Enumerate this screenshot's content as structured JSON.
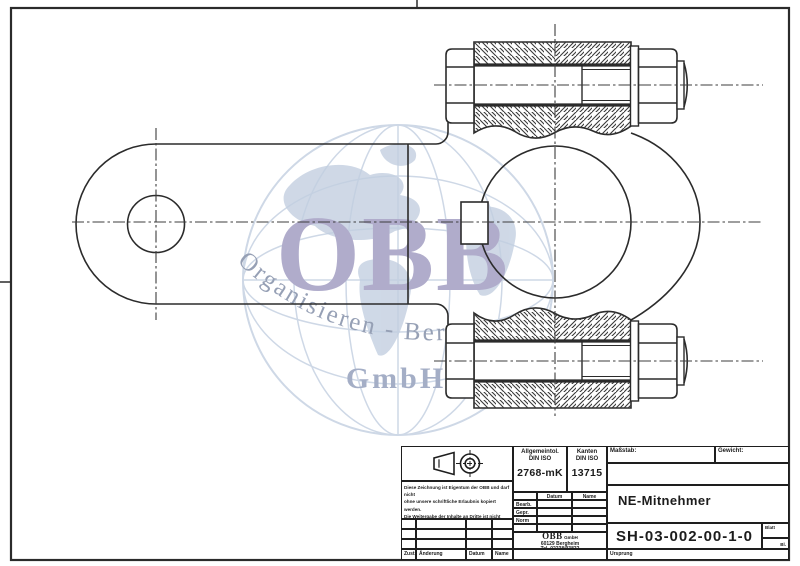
{
  "colors": {
    "line": "#2b2b2b",
    "centerline": "#3d3d3d",
    "watermark_globe": "#c9d4e4",
    "watermark_land": "#bccadd",
    "watermark_obb": "#a8a4c6",
    "watermark_arc_text": "#8b96ae",
    "watermark_gmbh": "#9ba6c0"
  },
  "watermark": {
    "arc_text": "Organisieren - Beraten - Besorgen",
    "big_text": "OBB",
    "gmbh_text": "GmbH"
  },
  "title_block": {
    "tolerance": {
      "label": "Allgemeintol.",
      "std": "DIN ISO",
      "value": "2768-mK"
    },
    "edges": {
      "label": "Kanten",
      "std": "DIN ISO",
      "value": "13715"
    },
    "scale_label": "Maßstab:",
    "weight_label": "Gewicht:",
    "part_name": "NE-Mitnehmer",
    "drawing_number": "SH-03-002-00-1-0",
    "company": {
      "name": "OBB",
      "suffix": "GmbH",
      "address": "60129 Bergheim",
      "phone": "Tel. 02238/93832"
    },
    "signatures": {
      "date_col": "Datum",
      "name_col": "Name",
      "rows": [
        "Bearb.",
        "Gepr.",
        "Norm"
      ]
    },
    "revision": {
      "zust": "Zust.",
      "aenderung": "Änderung",
      "datum": "Datum",
      "name": "Name"
    },
    "origin_label": "Ursprung",
    "sheet_label": "Blatt",
    "sheet_total_label": "Bl.",
    "disclaimer_lines": [
      "Diese Zeichnung ist Eigentum der OBB und darf nicht",
      "ohne unsere schriftliche Erlaubnis kopiert werden.",
      "Die Weitergabe der Inhalte an Dritte ist nicht gestattet",
      "und darf nur zu gemeinsamen Zwecken verwendet",
      "werden. © OBB GmbH"
    ]
  }
}
